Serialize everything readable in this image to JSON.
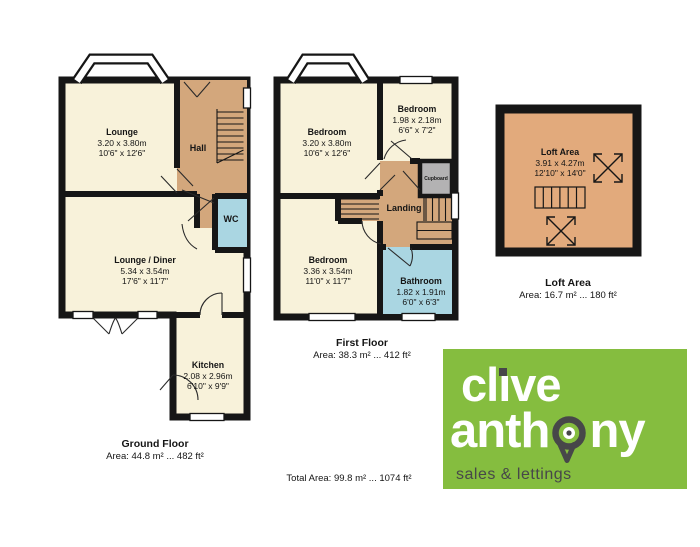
{
  "ground": {
    "lounge": {
      "name": "Lounge",
      "m": "3.20 x 3.80m",
      "ft": "10'6\" x 12'6\""
    },
    "hall": {
      "name": "Hall"
    },
    "wc": {
      "name": "WC"
    },
    "lounge_diner": {
      "name": "Lounge / Diner",
      "m": "5.34 x 3.54m",
      "ft": "17'6\" x 11'7\""
    },
    "kitchen": {
      "name": "Kitchen",
      "m": "2.08 x 2.96m",
      "ft": "6'10\" x 9'9\""
    },
    "floor_label": "Ground Floor",
    "floor_area": "Area: 44.8 m² ... 482 ft²"
  },
  "first": {
    "bedroom1": {
      "name": "Bedroom",
      "m": "3.20 x 3.80m",
      "ft": "10'6\" x 12'6\""
    },
    "bedroom2": {
      "name": "Bedroom",
      "m": "1.98 x 2.18m",
      "ft": "6'6\" x 7'2\""
    },
    "cupboard": {
      "name": "Cupboard"
    },
    "landing": {
      "name": "Landing"
    },
    "bedroom3": {
      "name": "Bedroom",
      "m": "3.36 x 3.54m",
      "ft": "11'0\" x 11'7\""
    },
    "bathroom": {
      "name": "Bathroom",
      "m": "1.82 x 1.91m",
      "ft": "6'0\" x 6'3\""
    },
    "floor_label": "First Floor",
    "floor_area": "Area: 38.3 m² ... 412 ft²"
  },
  "loft": {
    "room": {
      "name": "Loft Area",
      "m": "3.91 x 4.27m",
      "ft": "12'10\" x 14'0\""
    },
    "floor_label": "Loft Area",
    "floor_area": "Area: 16.7 m² ... 180 ft²"
  },
  "total_area": "Total Area: 99.8 m² ... 1074 ft²",
  "logo": {
    "word1_pre": "cl",
    "word1_i": "ı",
    "word1_post": "ve",
    "word2_pre": "anth",
    "word2_post": "ny",
    "tagline": "sales & lettings"
  },
  "colors": {
    "room_cream": "#F8F2DA",
    "hall_tan": "#D3A77C",
    "loft_tan": "#E2AA7C",
    "wet_blue": "#AAD6E2",
    "cupboard_grey": "#B3B2B3",
    "wall_black": "#161616",
    "logo_green": "#85BD3F",
    "logo_dark": "#474749"
  }
}
